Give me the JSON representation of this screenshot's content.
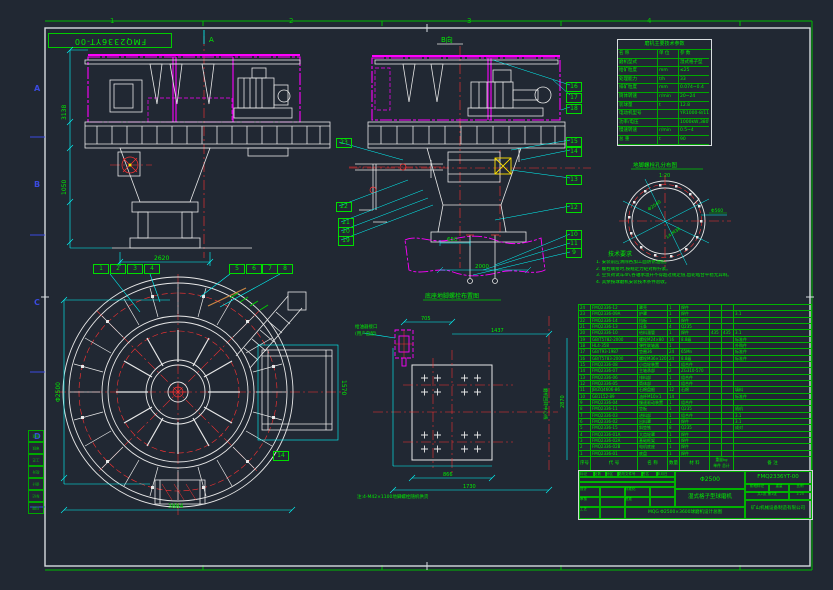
{
  "frame": {
    "zones_top": [
      "1",
      "2",
      "3",
      "4"
    ],
    "zones_left": [
      "A",
      "B",
      "C",
      "D"
    ],
    "corner_label": "FMQ2336YT-00"
  },
  "views": {
    "a": {
      "marker": "A",
      "dim_h1": "3138",
      "dim_h2": "1050",
      "dim_w": "2620"
    },
    "c": {
      "title": "B向",
      "dim_found": "650",
      "dim_base": "2000"
    },
    "b": {
      "dim_d": "Φ2500",
      "dim_w": "3884",
      "dim_duct": "1570"
    },
    "d": {
      "title": "底座地脚螺栓布置图",
      "dim1": "705",
      "dim2": "1437",
      "dim3": "2870",
      "dim4": "866",
      "dim5": "1730",
      "axis_label": "磨机回转中心线",
      "part_label1": "给油器接口",
      "part_label2": "(用户自配)",
      "note": "注:4-M42×1100地脚螺栓随机供货"
    },
    "detail": {
      "title": "地脚螺栓孔分布图",
      "scale": "1:20",
      "dim1": "Φ2040",
      "dim2": "14-M36",
      "dim3": "Φ560"
    }
  },
  "params": {
    "title": "磨机主要技术参数",
    "header": {
      "c1": "名 称",
      "c2": "单 位",
      "c3": "参 数"
    },
    "rows": [
      {
        "label": "磨机型式",
        "unit": "",
        "value": "湿式格子型"
      },
      {
        "label": "给矿粒度",
        "unit": "mm",
        "value": "≤25"
      },
      {
        "label": "处理能力",
        "unit": "t/h",
        "value": "33"
      },
      {
        "label": "排矿粒度",
        "unit": "mm",
        "value": "0.074~0.4"
      },
      {
        "label": "筒体转速",
        "unit": "r/min",
        "value": "20~24"
      },
      {
        "label": "装球量",
        "unit": "t",
        "value": "12.8"
      },
      {
        "label": "电动机型号",
        "unit": "",
        "value": "YR1000-8/1180"
      },
      {
        "label": "功率/电压",
        "unit": "",
        "value": "1000kW,380V"
      },
      {
        "label": "慢速转速",
        "unit": "r/min",
        "value": "0.5~4"
      },
      {
        "label": "总  重",
        "unit": "t",
        "value": "90"
      }
    ]
  },
  "notes": {
    "title": "技术要求",
    "lines": [
      "1. 安装前应清除各加工面防锈油脂。",
      "2. 螺栓联接时,按规定力矩对称拧紧。",
      "3. 空负荷试车4h,各轴承温升不得超过规定值,齿轮啮合平稳无异响。",
      "4. 其余按球磨机安装技术条件验收。"
    ]
  },
  "bom": {
    "headers": {
      "no": "序号",
      "code": "代  号",
      "name": "名  称",
      "qty": "数量",
      "mat": "材  料",
      "weight": "重量kg",
      "single": "单件",
      "total": "总计",
      "note": "备 注"
    },
    "rows": [
      {
        "no": "24",
        "code": "FMQ2336-12",
        "name": "罩壳",
        "qty": "1",
        "mat": "焊件",
        "single": "",
        "total": "",
        "note": ""
      },
      {
        "no": "23",
        "code": "FMQ2336-09A",
        "name": "护罩",
        "qty": "1",
        "mat": "焊件",
        "single": "",
        "total": "",
        "note": "3.1"
      },
      {
        "no": "22",
        "code": "FMQ2336-14",
        "name": "挡板",
        "qty": "1",
        "mat": "焊件",
        "single": "",
        "total": "",
        "note": ""
      },
      {
        "no": "21",
        "code": "FMQ2336-13",
        "name": "压条",
        "qty": "4",
        "mat": "Q235",
        "single": "",
        "total": "",
        "note": ""
      },
      {
        "no": "20",
        "code": "FMQ2336-10",
        "name": "给料溜管",
        "qty": "1",
        "mat": "焊件",
        "single": "435",
        "total": "435",
        "note": "3.1"
      },
      {
        "no": "19",
        "code": "GB/T5782-2000",
        "name": "螺栓M24×80",
        "qty": "16",
        "mat": "8.8级",
        "single": "",
        "total": "",
        "note": "标准件"
      },
      {
        "no": "18",
        "code": "HL4-358",
        "name": "弹性联轴器",
        "qty": "1",
        "mat": "",
        "single": "",
        "total": "",
        "note": "外购件"
      },
      {
        "no": "17",
        "code": "GB/T93-1987",
        "name": "垫圈36",
        "qty": "24",
        "mat": "65Mn",
        "single": "",
        "total": "",
        "note": "标准件"
      },
      {
        "no": "16",
        "code": "GB/T5783-2000",
        "name": "螺栓M36×120",
        "qty": "24",
        "mat": "8.8级",
        "single": "",
        "total": "",
        "note": "标准件"
      },
      {
        "no": "15",
        "code": "FMQ2336-08",
        "name": "小齿轮装置",
        "qty": "1",
        "mat": "组合件",
        "single": "",
        "total": "",
        "note": ""
      },
      {
        "no": "14",
        "code": "FMQ2336-07",
        "name": "主轴承部",
        "qty": "2",
        "mat": "ZG310-570",
        "single": "",
        "total": "",
        "note": ""
      },
      {
        "no": "13",
        "code": "FMQ2336-06",
        "name": "排料部",
        "qty": "1",
        "mat": "组合件",
        "single": "",
        "total": "",
        "note": ""
      },
      {
        "no": "12",
        "code": "FMQ2336-05",
        "name": "筒体部",
        "qty": "1",
        "mat": "组合件",
        "single": "",
        "total": "",
        "note": ""
      },
      {
        "no": "11",
        "code": "JB/ZQ4606-86",
        "name": "石棉盘根",
        "qty": "12",
        "mat": "石棉",
        "single": "",
        "total": "",
        "note": "填料"
      },
      {
        "no": "10",
        "code": "GB1152-89",
        "name": "油杯M10×1",
        "qty": "14",
        "mat": "",
        "single": "",
        "total": "",
        "note": "标准件"
      },
      {
        "no": "9",
        "code": "FMQ2336-04",
        "name": "慢速驱动装置",
        "qty": "1",
        "mat": "组合件",
        "single": "",
        "total": "",
        "note": ""
      },
      {
        "no": "8",
        "code": "FMQ2336-11",
        "name": "垫板",
        "qty": "1",
        "mat": "Q235",
        "single": "",
        "total": "",
        "note": "随机"
      },
      {
        "no": "7",
        "code": "FMQ2336-03",
        "name": "进料部",
        "qty": "1",
        "mat": "组合件",
        "single": "",
        "total": "",
        "note": "3.1"
      },
      {
        "no": "6",
        "code": "FMQ2336-02",
        "name": "出料罩",
        "qty": "1",
        "mat": "焊件",
        "single": "",
        "total": "",
        "note": "3.1"
      },
      {
        "no": "5",
        "code": "FMQ2336-15",
        "name": "斜垫铁",
        "qty": "8",
        "mat": "Q235",
        "single": "",
        "total": "",
        "note": "成对"
      },
      {
        "no": "4",
        "code": "FMQ2336-01A",
        "name": "大齿轮罩",
        "qty": "1",
        "mat": "焊件",
        "single": "",
        "total": "",
        "note": ""
      },
      {
        "no": "3",
        "code": "FMQ2336-02A",
        "name": "基础框架",
        "qty": "1",
        "mat": "焊件",
        "single": "",
        "total": "",
        "note": ""
      },
      {
        "no": "2",
        "code": "FMQ2336-02B",
        "name": "电机底座",
        "qty": "1",
        "mat": "焊件",
        "single": "",
        "total": "",
        "note": ""
      },
      {
        "no": "1",
        "code": "FMQ2336-01",
        "name": "底盘",
        "qty": "1",
        "mat": "焊件",
        "single": "",
        "total": "",
        "note": ""
      }
    ]
  },
  "titleblock": {
    "drawing_no": "FMQ2336YT-00",
    "product": "Φ2500",
    "product2": "湿式格子型球磨机",
    "caption": "MQG Φ2500×3600球磨机设计总图",
    "company": "矿山机械设备制造有限公司",
    "cells": {
      "mark": "标记",
      "count": "处数",
      "zone": "分区",
      "doc": "更改文件号",
      "sign": "签名",
      "date": "年月日",
      "design": "设计",
      "check": "审核",
      "process": "工艺",
      "std": "标准化",
      "approve": "批准",
      "stage": "阶段标记",
      "weight": "重量",
      "scale": "比例",
      "scale_val": "1:25",
      "sheet": "共1张 第1张"
    }
  },
  "callouts": [
    "1",
    "2",
    "3",
    "4",
    "5",
    "6",
    "7",
    "8",
    "14",
    "16",
    "17",
    "18",
    "15",
    "14",
    "13",
    "12",
    "10",
    "11",
    "9",
    "23",
    "22",
    "21",
    "20",
    "19"
  ],
  "side_table": [
    "批准",
    "审核",
    "工艺",
    "校对",
    "设计",
    "标记",
    "日期"
  ]
}
